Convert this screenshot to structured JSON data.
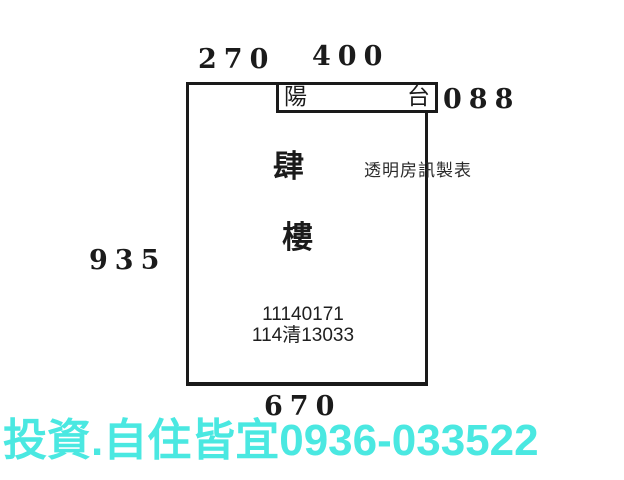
{
  "floorplan": {
    "dimensions": {
      "top_left": "270",
      "top_right": "400",
      "right": "088",
      "left": "935",
      "bottom": "670"
    },
    "balcony": {
      "left_char": "陽",
      "right_char": "台"
    },
    "floor_label": {
      "char1": "肆",
      "char2": "樓"
    },
    "watermark": "透明房訊製表",
    "registration_numbers": {
      "line1": "11140171",
      "line2": "114清13033"
    }
  },
  "footer": {
    "ad_text": "投資.自住皆宜0936-033522"
  },
  "colors": {
    "line_black": "#1a1a1a",
    "ad_cyan": "#4ae8e1",
    "background": "#ffffff"
  }
}
